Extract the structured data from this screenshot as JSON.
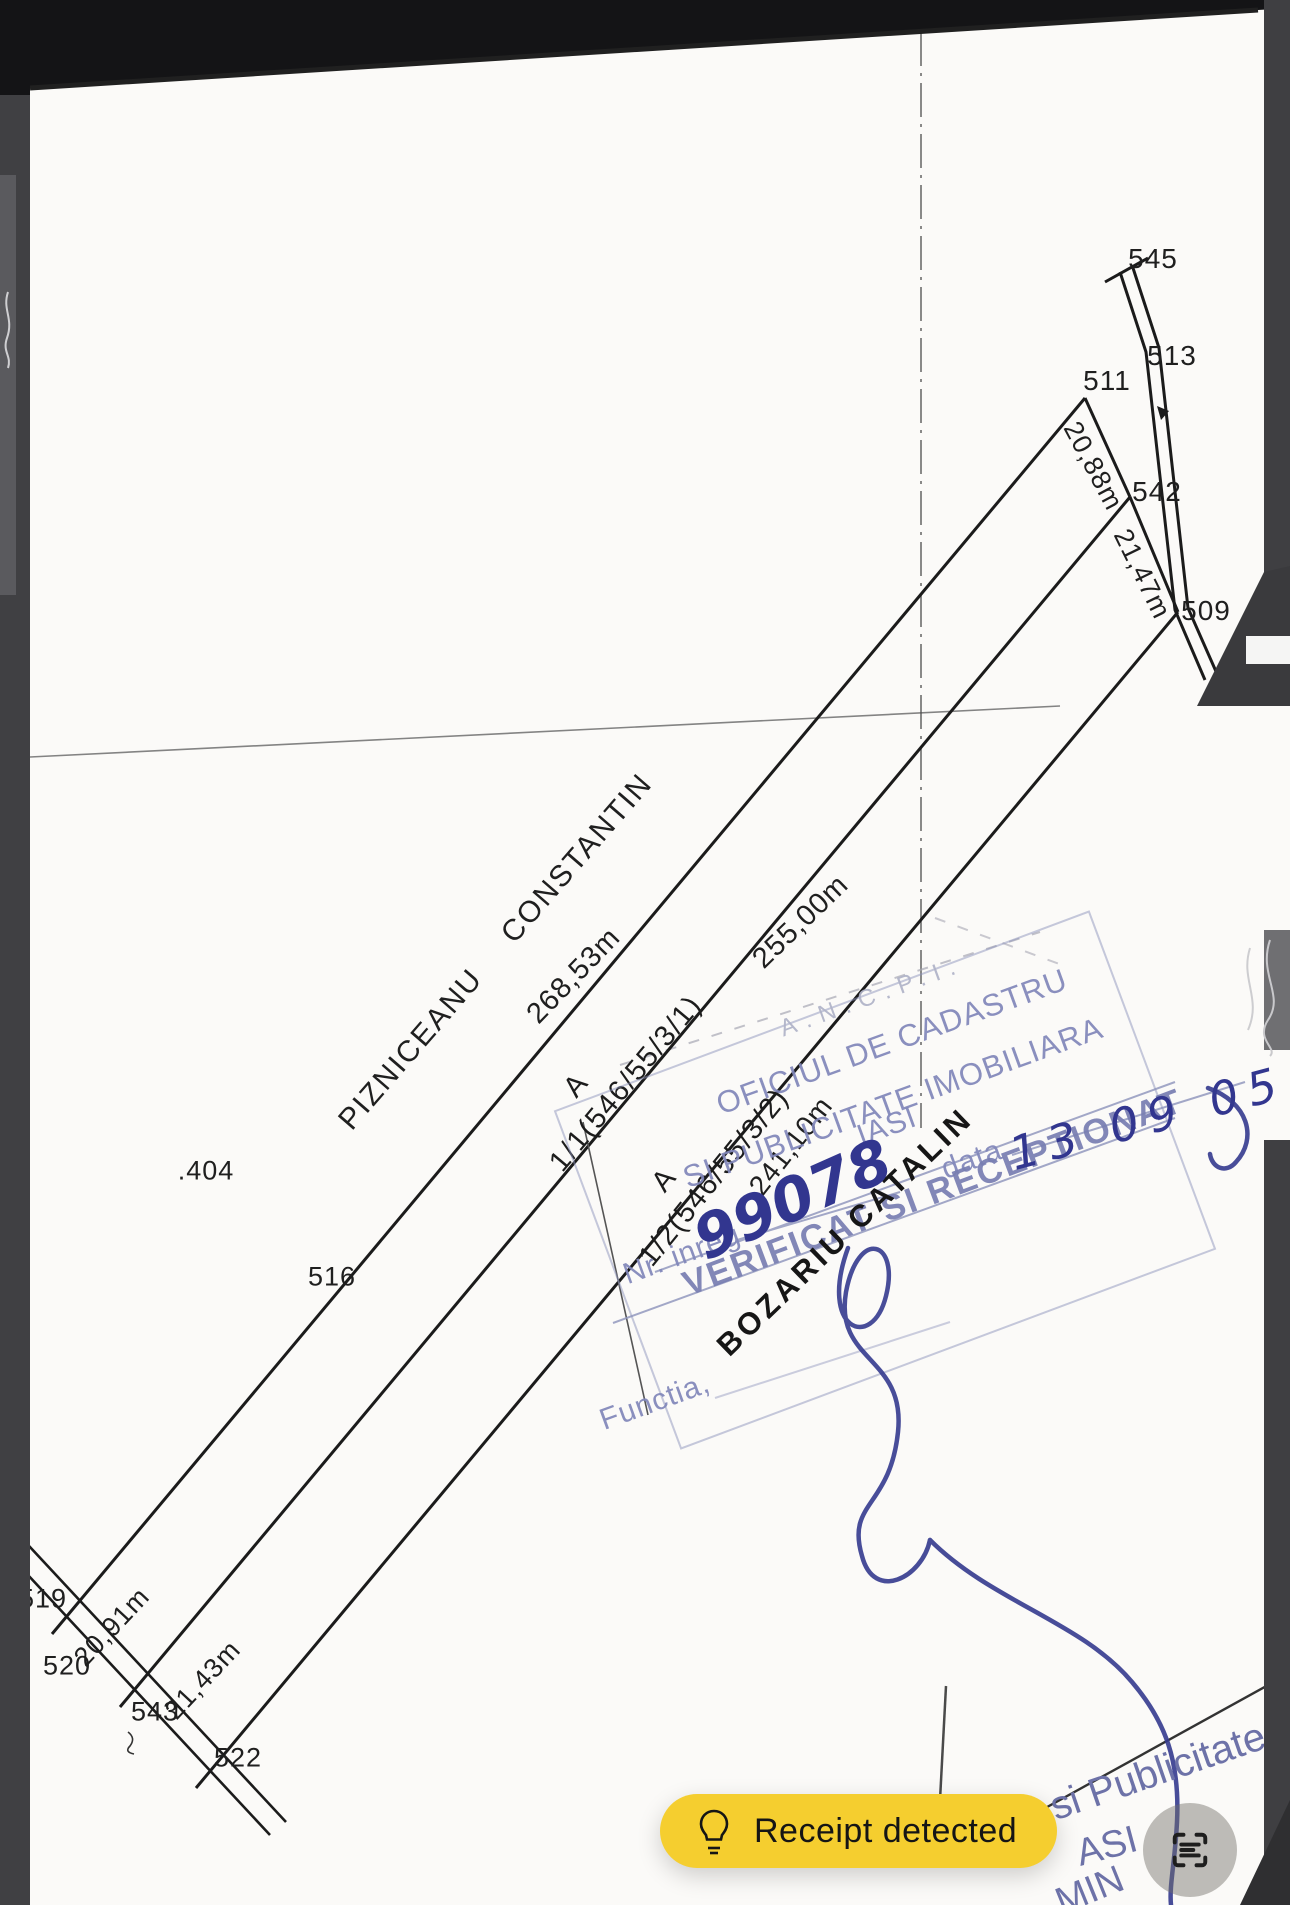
{
  "map": {
    "owner": {
      "first": "PIZNICEANU",
      "last": "CONSTANTIN"
    },
    "parcels": [
      {
        "zone": "A",
        "code": "1/1(546/55/3/1)",
        "length": "268,53m"
      },
      {
        "zone": "A",
        "code": "1/2(546/55/3/2)",
        "length": "255,00m",
        "inner_length": "241,10m"
      }
    ],
    "points": {
      "p545": "545",
      "p513": "513",
      "p511": "511",
      "p542": "542",
      "p509": "509",
      "p516": "516",
      "p404": ".404",
      "p519": "519",
      "p520": "520",
      "p543": "543",
      "p522": "522"
    },
    "widths": {
      "w1": "20,88m",
      "w2": "21,47m",
      "w3": "20,91m",
      "w4": "21,43m"
    }
  },
  "stamp": {
    "agency": "A.N.C.P.I.",
    "office_line1": "OFICIUL DE CADASTRU",
    "office_line2": "SI PUBLICITATE IMOBILIARA",
    "city": "IASI",
    "reg_label": "Nr. inreg",
    "date_label": "data",
    "status": "VERIFICAT SI RECEPTIONAT",
    "role_label": "Functia,",
    "officer": "BOZARIU CATALIN"
  },
  "handwriting": {
    "reg_no": "99078",
    "date": "13 09 05"
  },
  "fragments": {
    "f1": "si Publicitate",
    "f2": "ASI",
    "f3": "MIN"
  },
  "ui": {
    "detection_pill": {
      "label": "Receipt detected",
      "bg": "#F5CE2F"
    },
    "colors": {
      "ink_blue": "#32368f",
      "stamp_blue": "#8187ba",
      "frame_dark": "#3f3f42"
    }
  }
}
